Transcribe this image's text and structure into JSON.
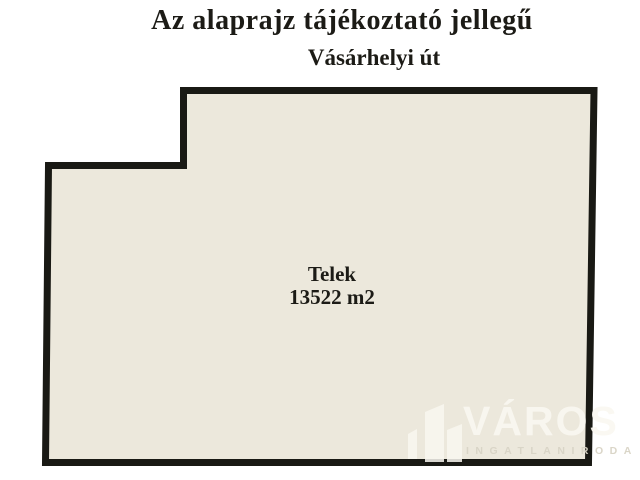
{
  "title": {
    "main": "Az alaprajz tájékoztató jellegű",
    "street": "Vásárhelyi út"
  },
  "plot": {
    "label": "Telek",
    "area": "13522 m2"
  },
  "watermark": {
    "brand": "VÁROS",
    "subtitle": "INGATLANIRODA",
    "icon": "buildings-icon"
  },
  "colors": {
    "background": "#ffffff",
    "plot_fill": "#ece8dc",
    "outline": "#191914",
    "text": "#1c1b16",
    "watermark_brand": "#faf8f1",
    "watermark_subtitle": "#d9d4c6"
  }
}
